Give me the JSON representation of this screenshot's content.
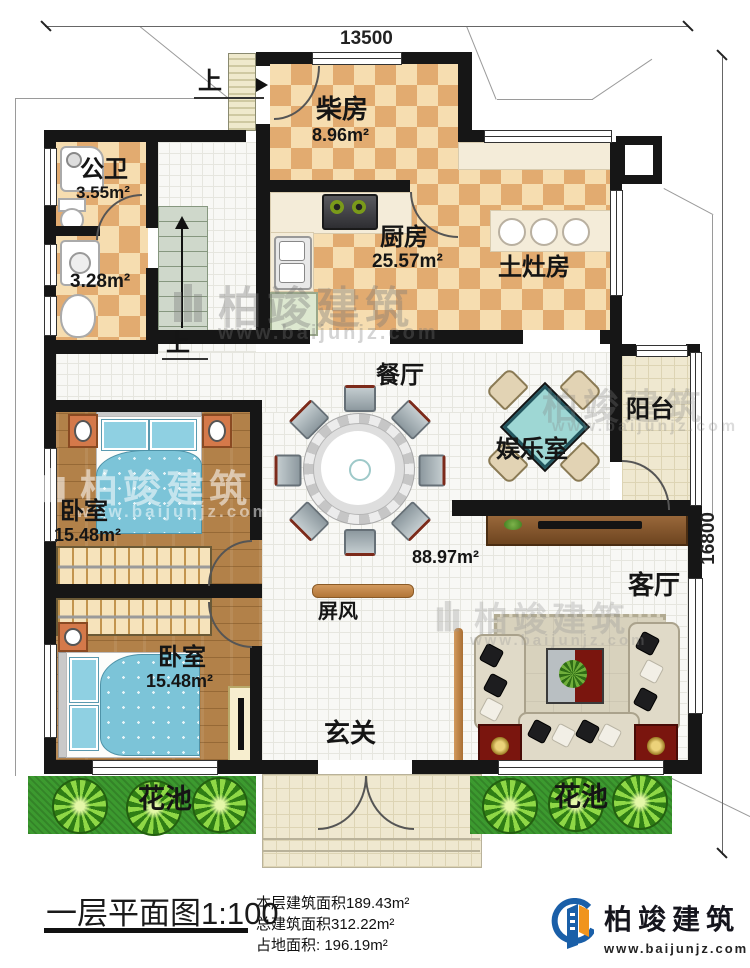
{
  "dimensions": {
    "top": "13500",
    "right": "16800"
  },
  "rooms": {
    "chai": {
      "label": "柴房",
      "area": "8.96m²"
    },
    "gongwei": {
      "label": "公卫",
      "area": "3.55m²"
    },
    "wash": {
      "area": "3.28m²"
    },
    "kitchen": {
      "label": "厨房",
      "area": "25.57m²"
    },
    "tuzao": {
      "label": "土灶房"
    },
    "dining": {
      "label": "餐厅"
    },
    "fun": {
      "label": "娱乐室"
    },
    "balcony": {
      "label": "阳台"
    },
    "bed1": {
      "label": "卧室",
      "area": "15.48m²"
    },
    "bed2": {
      "label": "卧室",
      "area": "15.48m²"
    },
    "living": {
      "label": "客厅"
    },
    "hall": {
      "area": "88.97m²",
      "entry": "玄关",
      "screen": "屏风"
    },
    "flower_left": {
      "label": "花池"
    },
    "flower_right": {
      "label": "花池"
    }
  },
  "stairs": {
    "up1": "上",
    "up2": "上"
  },
  "footer": {
    "title": "一层平面图",
    "scale": "1:100",
    "stat1": "本层建筑面积189.43m²",
    "stat2": "总建筑面积312.22m²",
    "stat3": "占地面积: 196.19m²"
  },
  "brand": {
    "name": "柏竣建筑",
    "site": "www.baijunjz.com"
  },
  "watermark": {
    "name": "柏竣建筑",
    "site": "www.baijunjz.com"
  },
  "colors": {
    "wall": "#161616",
    "tile_light": "#f6ddb0",
    "tile_dark": "#e2ab70",
    "wood": "#b28149",
    "grass": "#3c9a2f",
    "brand_blue": "#1a5fa8",
    "brand_orange": "#f0941d"
  }
}
